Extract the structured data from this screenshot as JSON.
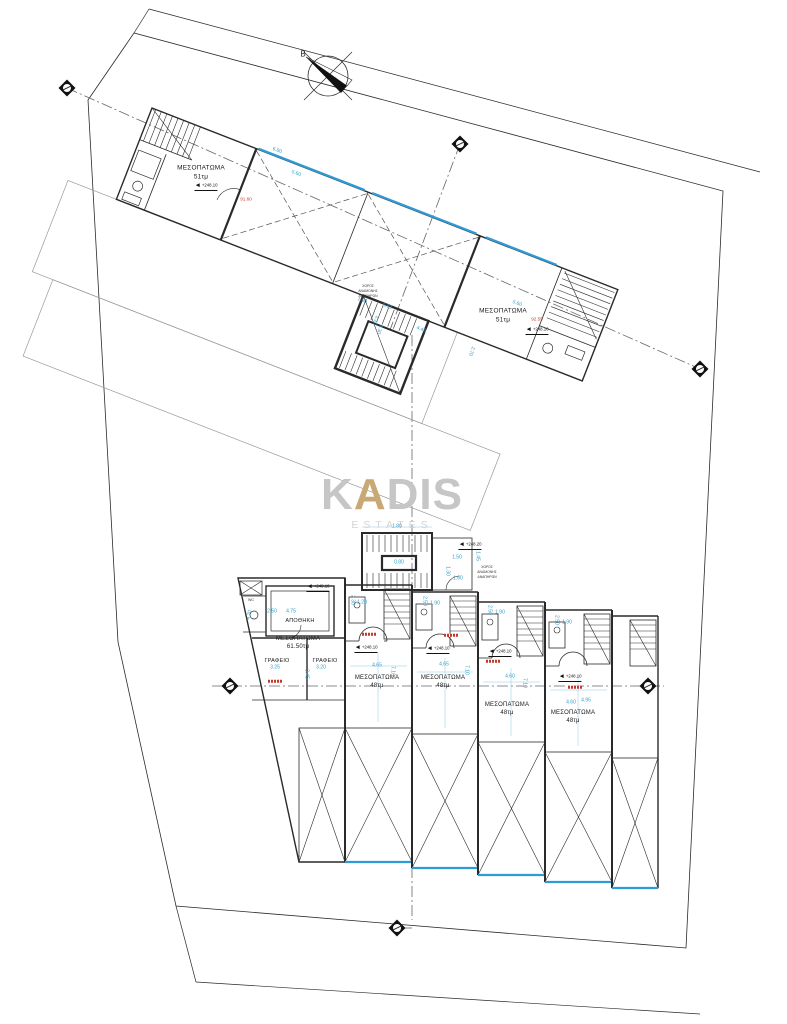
{
  "drawing": {
    "watermark": {
      "k": "K",
      "a": "A",
      "dis": "DIS",
      "subtitle": "ESTATES",
      "accent_color": "#c8a874",
      "text_color": "#c6c6c6"
    },
    "north": {
      "label": "Β"
    },
    "colors": {
      "dimension": "#2f9ec9",
      "glazing": "#2e9bd6",
      "line": "#2a2a2a",
      "axis": "#666666",
      "red": "#c0392b"
    },
    "upper_plan": {
      "unit_left": {
        "name": "ΜΕΣΟΠΑΤΩΜΑ",
        "area": "51τμ",
        "red_area": "91.60"
      },
      "unit_right": {
        "name": "ΜΕΣΟΠΑΤΩΜΑ",
        "area": "51τμ",
        "red_area": "92.55"
      },
      "stair_note_lines": [
        "ΧΩΡΟΣ",
        "ΑΝΑΜΟΝΗΣ",
        "ΑΝΑΠΗΡΩΝ"
      ]
    },
    "lower_plan": {
      "stair_note_lines": [
        "ΧΩΡΟΣ",
        "ΑΝΑΜΟΝΗΣ",
        "ΑΝΑΠΗΡΩΝ"
      ],
      "unit_main": {
        "name": "ΜΕΣΟΠΑΤΩΜΑ",
        "area": "61.50τμ",
        "storage": "ΑΠΟΘΗΚΗ",
        "office1": "ΓΡΑΦΕΙΟ",
        "office2": "ΓΡΑΦΕΙΟ",
        "wc": "WC"
      },
      "units": [
        {
          "name": "ΜΕΣΟΠΑΤΩΜΑ",
          "area": "48τμ"
        },
        {
          "name": "ΜΕΣΟΠΑΤΩΜΑ",
          "area": "48τμ"
        },
        {
          "name": "ΜΕΣΟΠΑΤΩΜΑ",
          "area": "48τμ"
        },
        {
          "name": "ΜΕΣΟΠΑΤΩΜΑ",
          "area": "48τμ"
        }
      ]
    },
    "levels": [
      {
        "t": "+248.10",
        "x": 206,
        "y": 187
      },
      {
        "t": "+248.10",
        "x": 537,
        "y": 331
      },
      {
        "t": "+248.20",
        "x": 470,
        "y": 546
      },
      {
        "t": "+248.10",
        "x": 318,
        "y": 588
      },
      {
        "t": "+248.10",
        "x": 366,
        "y": 649
      },
      {
        "t": "+248.10",
        "x": 438,
        "y": 650
      },
      {
        "t": "+248.10",
        "x": 500,
        "y": 653
      },
      {
        "t": "+248.10",
        "x": 570,
        "y": 678
      }
    ],
    "dims": [
      {
        "t": "6.80",
        "x": 277,
        "y": 151,
        "r": 21
      },
      {
        "t": "5.60",
        "x": 296,
        "y": 174,
        "r": 21
      },
      {
        "t": "5.60",
        "x": 517,
        "y": 304,
        "r": 21
      },
      {
        "t": "6.93",
        "x": 387,
        "y": 307,
        "r": 21
      },
      {
        "t": "1.50",
        "x": 362,
        "y": 301,
        "r": 21
      },
      {
        "t": "1.20",
        "x": 375,
        "y": 320,
        "r": 111
      },
      {
        "t": "1.30",
        "x": 379,
        "y": 329,
        "r": 111
      },
      {
        "t": "4.46",
        "x": 421,
        "y": 330,
        "r": 21
      },
      {
        "t": "2.70",
        "x": 471,
        "y": 351,
        "r": 111
      },
      {
        "t": "1.80",
        "x": 397,
        "y": 527,
        "r": 0
      },
      {
        "t": "1.50",
        "x": 457,
        "y": 558,
        "r": 0
      },
      {
        "t": "1.45",
        "x": 477,
        "y": 556,
        "r": 90
      },
      {
        "t": "1.30",
        "x": 447,
        "y": 571,
        "r": 90
      },
      {
        "t": "1.60",
        "x": 458,
        "y": 579,
        "r": 0
      },
      {
        "t": "0.80",
        "x": 399,
        "y": 563,
        "r": 0
      },
      {
        "t": "4.75",
        "x": 291,
        "y": 612,
        "r": 0
      },
      {
        "t": "2.50",
        "x": 272,
        "y": 612,
        "r": 0
      },
      {
        "t": "4.70",
        "x": 250,
        "y": 615,
        "r": -78
      },
      {
        "t": "3.25",
        "x": 275,
        "y": 668,
        "r": 0
      },
      {
        "t": "3.20",
        "x": 321,
        "y": 668,
        "r": 0
      },
      {
        "t": "3.45",
        "x": 306,
        "y": 674,
        "r": 90
      },
      {
        "t": "2.30",
        "x": 352,
        "y": 600,
        "r": 90
      },
      {
        "t": "1.20",
        "x": 362,
        "y": 603,
        "r": 0
      },
      {
        "t": "4.65",
        "x": 377,
        "y": 666,
        "r": 0
      },
      {
        "t": "7.10",
        "x": 392,
        "y": 671,
        "r": 90
      },
      {
        "t": "2.50",
        "x": 424,
        "y": 601,
        "r": 90
      },
      {
        "t": "1.90",
        "x": 435,
        "y": 604,
        "r": 0
      },
      {
        "t": "4.65",
        "x": 444,
        "y": 665,
        "r": 0
      },
      {
        "t": "7.10",
        "x": 466,
        "y": 670,
        "r": 90
      },
      {
        "t": "2.50",
        "x": 489,
        "y": 610,
        "r": 90
      },
      {
        "t": "1.90",
        "x": 500,
        "y": 613,
        "r": 0
      },
      {
        "t": "4.60",
        "x": 510,
        "y": 677,
        "r": 0
      },
      {
        "t": "7.10",
        "x": 524,
        "y": 683,
        "r": 90
      },
      {
        "t": "2.50",
        "x": 556,
        "y": 620,
        "r": 90
      },
      {
        "t": "1.90",
        "x": 567,
        "y": 623,
        "r": 0
      },
      {
        "t": "4.60",
        "x": 571,
        "y": 703,
        "r": 0
      },
      {
        "t": "4.95",
        "x": 586,
        "y": 701,
        "r": 0
      }
    ],
    "red_bars": [
      {
        "x": 275,
        "y": 681
      },
      {
        "x": 369,
        "y": 634
      },
      {
        "x": 451,
        "y": 635
      },
      {
        "x": 493,
        "y": 661
      },
      {
        "x": 575,
        "y": 687
      }
    ]
  }
}
